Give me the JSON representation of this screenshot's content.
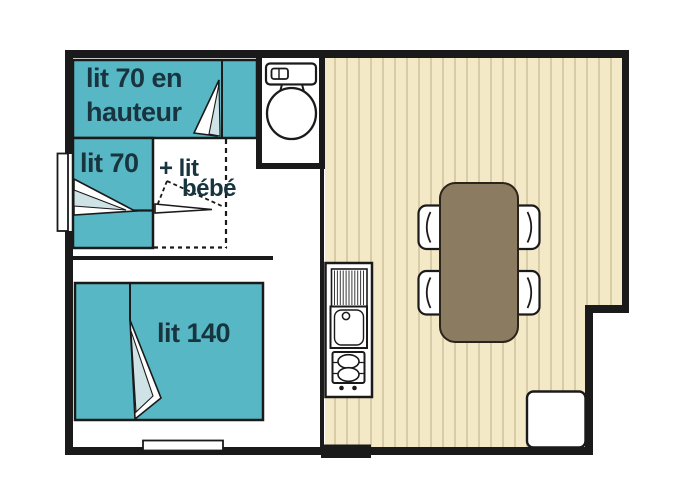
{
  "plan": {
    "type": "mobile-home floor plan",
    "labels": {
      "bunk_bed_line1": "lit 70 en",
      "bunk_bed_line2": "hauteur",
      "single_bed": "lit 70",
      "baby_bed_line1": "+ lit",
      "baby_bed_line2": "bébé",
      "double_bed": "lit 140"
    },
    "icons": [
      "blanket-fold-icon",
      "baby-bed-fold-icon",
      "toilet-icon",
      "kitchen-drainboard-icon",
      "kitchen-sink-icon",
      "stove-burners-icon",
      "dining-table",
      "chair-icon",
      "storage-cabinet",
      "window-marker",
      "entrance-threshold"
    ],
    "colors": {
      "wall": "#1a1a1a",
      "bed_teal": "#58b7c4",
      "fold_pale": "#cfe2e6",
      "label_navy": "#18343f",
      "floor_beige": "#f4e9c7",
      "floor_stripe": "#cfc29d",
      "table_brown": "#8b7b60",
      "table_outline": "#2b241a",
      "fixture_white": "#ffffff"
    }
  }
}
